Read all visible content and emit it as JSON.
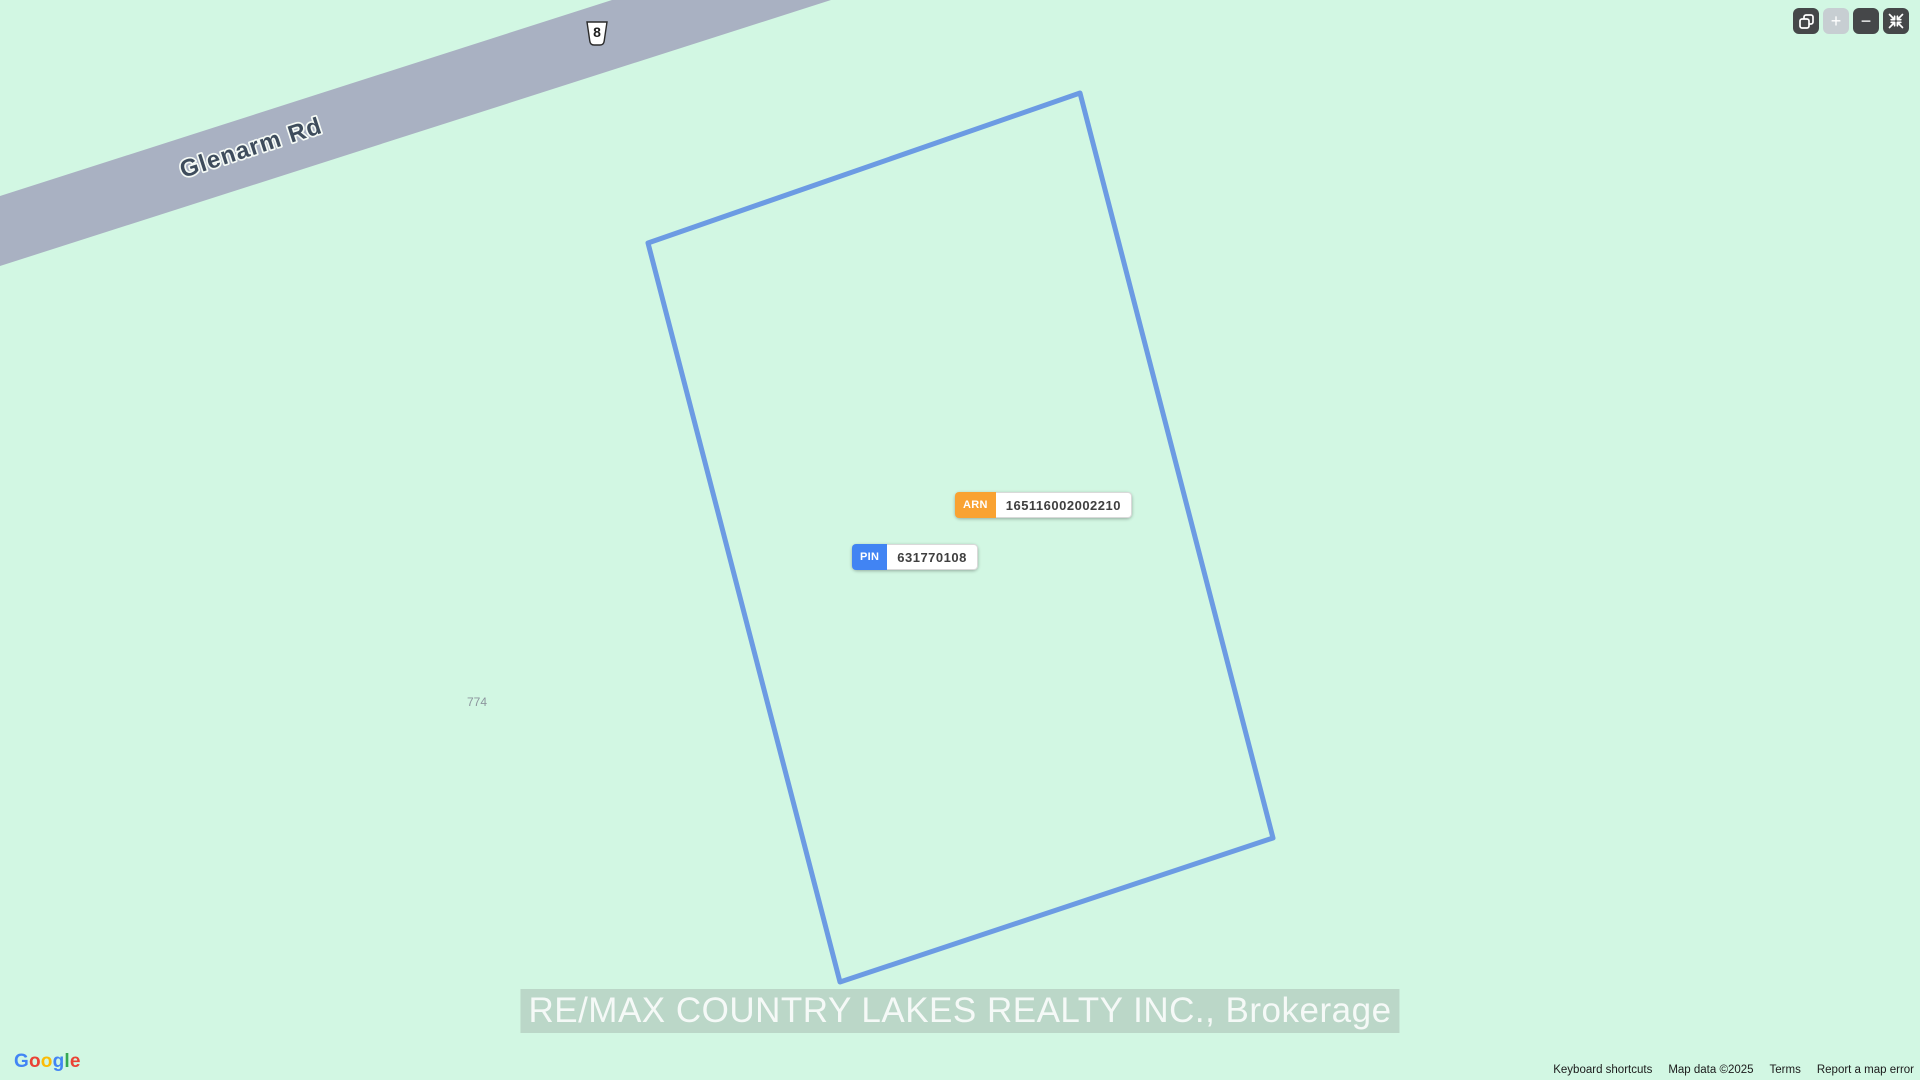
{
  "map": {
    "background_color": "#D2F7E3",
    "road": {
      "name": "Glenarm Rd",
      "route_badge": "8",
      "surface_color": "#A9B1C2",
      "polygon_points": "0,196 612,0 831,0 0,266",
      "label_color": "#3E4C5C"
    },
    "parcel": {
      "outline_color": "#6C9BE3",
      "outline_width": "5",
      "polygon_points": "1080,93 648,243 840,982 1273,838"
    },
    "house_number": "774",
    "tags": {
      "arn": {
        "label": "ARN",
        "value": "165116002002210",
        "badge_color": "#F9A232"
      },
      "pin": {
        "label": "PIN",
        "value": "631770108",
        "badge_color": "#4184F3"
      }
    },
    "watermark": "RE/MAX COUNTRY LAKES REALTY INC., Brokerage"
  },
  "controls": {
    "copy_icon": "copy-icon",
    "zoom_in_glyph": "+",
    "zoom_out_glyph": "−",
    "compress_icon": "compress-icon"
  },
  "attribution": {
    "logo": {
      "text": "Google",
      "letter_colors": [
        "#4285F4",
        "#EA4335",
        "#FBBC05",
        "#4285F4",
        "#34A853",
        "#EA4335"
      ]
    },
    "keyboard_shortcuts": "Keyboard shortcuts",
    "map_data": "Map data ©2025",
    "terms": "Terms",
    "report_error": "Report a map error"
  }
}
